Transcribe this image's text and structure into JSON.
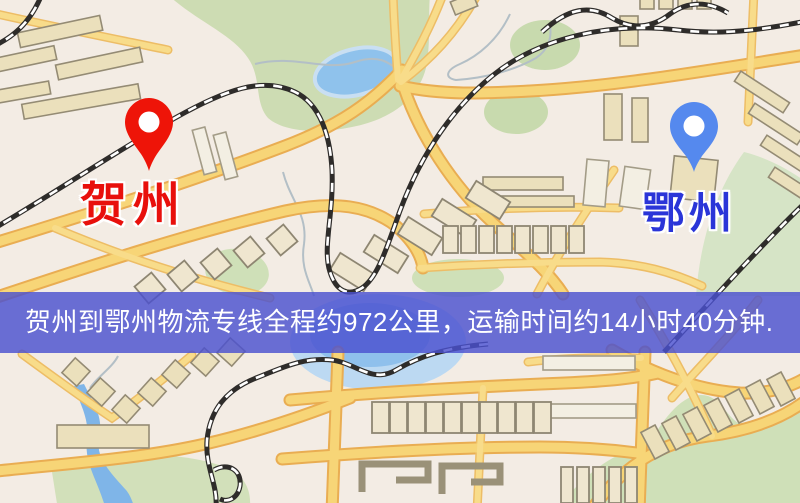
{
  "map": {
    "pins": [
      {
        "id": "origin",
        "label": "贺州",
        "pin_color": "#ee1408",
        "label_color": "#e8100c"
      },
      {
        "id": "destination",
        "label": "鄂州",
        "pin_color": "#5589ee",
        "label_color": "#2a35d8"
      }
    ],
    "banner": {
      "text": "贺州到鄂州物流专线全程约972公里，运输时间约14小时40分钟.",
      "background": "rgba(75,80,207,0.82)",
      "text_color": "#ffffff"
    },
    "legend_colors": {
      "map_background": "#f3ece4",
      "road_fill": "#f7d577",
      "road_casing": "#e9ad52",
      "park": "#cddcb3",
      "water": "#8fc2ec",
      "railway": "#2e2c2a",
      "building": "#ebe0bc"
    }
  }
}
